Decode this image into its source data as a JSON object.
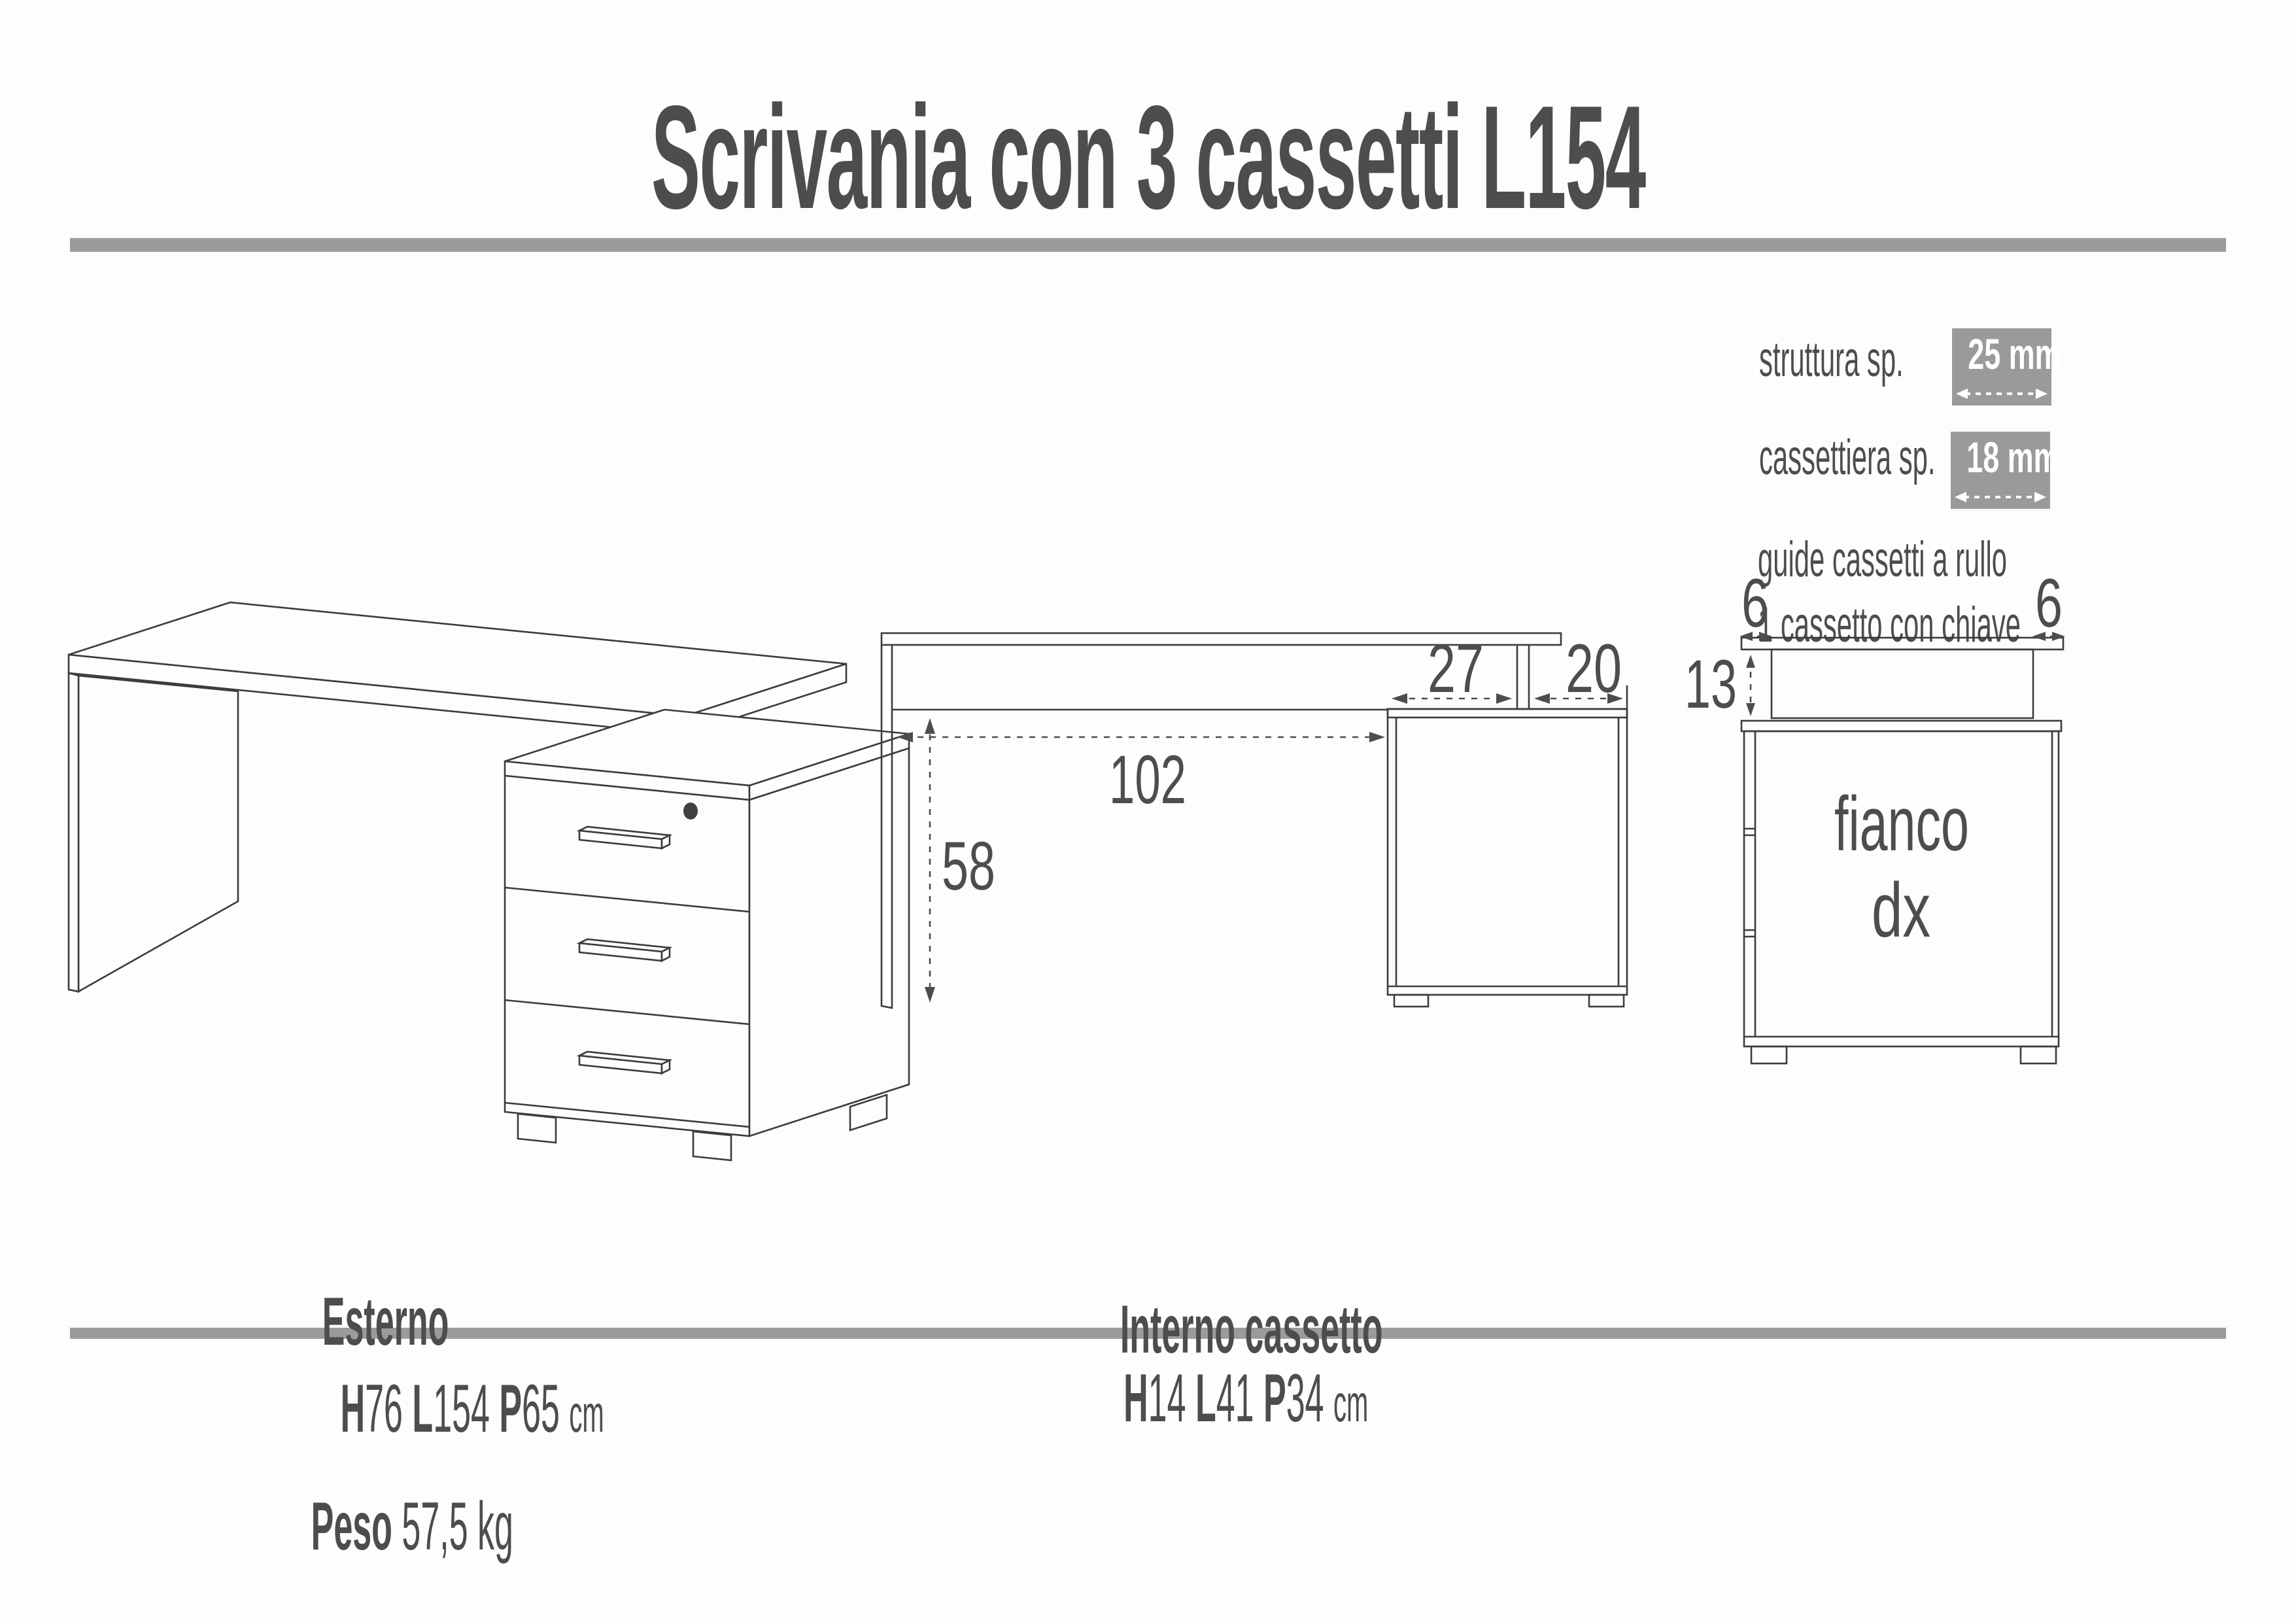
{
  "title": "Scrivania con 3 cassetti L154",
  "specs": {
    "row1_label": "struttura sp.",
    "row1_value": "25 mm",
    "row2_label": "cassettiera sp.",
    "row2_value": "18 mm",
    "note1": "guide cassetti a rullo",
    "note2": "1 cassetto con chiave"
  },
  "front_view": {
    "knee_width": "102",
    "clearance_height": "58",
    "top_segment_left": "27",
    "top_segment_right": "20"
  },
  "side_view": {
    "overhang_left": "6",
    "overhang_right": "6",
    "riser_height": "13",
    "label_line1": "fianco",
    "label_line2": "dx"
  },
  "footer": {
    "external": {
      "title": "Esterno",
      "h_label": "H",
      "h": "76",
      "l_label": "L",
      "l": "154",
      "p_label": "P",
      "p": "65",
      "unit": "cm"
    },
    "weight": {
      "label": "Peso",
      "value": "57,5 kg"
    },
    "drawer": {
      "title": "Interno cassetto",
      "h_label": "H",
      "h": "14",
      "l_label": "L",
      "l": "41",
      "p_label": "P",
      "p": "34",
      "unit": "cm"
    }
  },
  "colors": {
    "ink": "#4d4d4f",
    "line": "#3c3c3c",
    "accent_gray": "#9b9b9b",
    "badge_gray": "#9a9a9a"
  }
}
